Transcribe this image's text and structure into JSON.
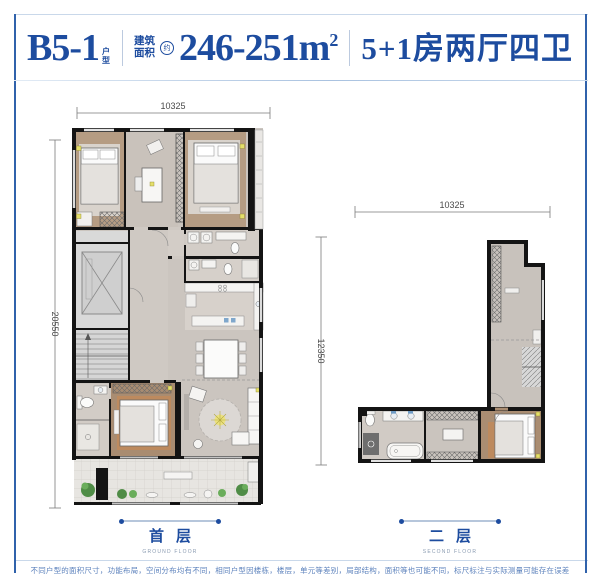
{
  "header": {
    "unit_name": "B5-1",
    "unit_type_label": "户型",
    "area_label_line1": "建筑",
    "area_label_line2": "面积",
    "area_approx": "约",
    "area_value": "246-251",
    "area_unit": "m",
    "area_unit_exp": "2",
    "layout_desc": "5+1房两厅四卫"
  },
  "floors": [
    {
      "name_cn": "首层",
      "name_en": "GROUND FLOOR",
      "dim_width": "10325",
      "dim_height": "20550"
    },
    {
      "name_cn": "二层",
      "name_en": "SECOND FLOOR",
      "dim_width": "10325",
      "dim_height": "12350"
    }
  ],
  "footer": {
    "disclaimer": "不同户型的面积尺寸，功能布局，空间分布均有不同，相同户型因楼栋，楼层，单元等差别，局部结构，面积等也可能不同，标尺标注与实际测量可能存在误差"
  },
  "colors": {
    "brand_blue": "#1d4c9f",
    "frame_blue": "#3062ab",
    "light_blue_line": "#c9d8ea",
    "wall_black": "#141414",
    "wood_floor": "#ab9078",
    "tile_floor": "#cbc5bf",
    "accent_yellow": "#e5df6a",
    "plant_green": "#4f8c46"
  }
}
